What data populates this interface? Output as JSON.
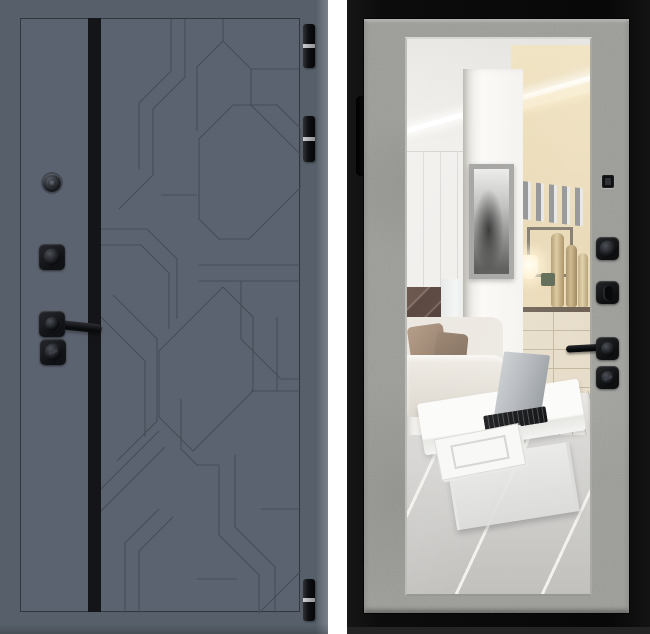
{
  "image_type": "product photo, steel entry door front and back views, no text",
  "front_door": {
    "view": "exterior-side",
    "finish": "graphite gray slab with milled geometric line pattern and black vertical accent stripe",
    "hardware": [
      "peephole",
      "deadbolt-knob",
      "lever-handle",
      "key-cylinder"
    ],
    "hinges": [
      "hinge-top",
      "hinge-upper",
      "hinge-bottom"
    ]
  },
  "back_door": {
    "view": "interior-side",
    "finish": "black slab frame with light concrete-texture surround and full-length mirror insert",
    "hardware": [
      "edge-pull-handle",
      "latch-cover",
      "deadbolt-knob",
      "thumbturn",
      "lever-handle",
      "night-latch-knob"
    ],
    "mirror_reflection": [
      "led-cove-ceiling-light",
      "white-column-with-framed-art-print",
      "white-wardrobe-cabinets",
      "dark-marble-backsplash",
      "metal-letter-wall-decor",
      "glowing-table-lamp",
      "ceramic-vases",
      "beige-sideboard-with-drawers",
      "white-sofa",
      "taupe-pillows",
      "white-coffee-table",
      "open-laptop",
      "magazines",
      "gray-striped-rug"
    ]
  },
  "colors": {
    "background": "#ffffff",
    "door_face": "#5c6370",
    "door_border": "#57606a",
    "pattern_line": "#454c56",
    "stripe": "#141518",
    "hinge_band": "#ccced1",
    "frame_black": "#0c0c0c",
    "concrete": "#9b9b97",
    "mirror_white": "#f2f0ec",
    "warm_wall": "#e9d9b6",
    "sofa": "#ece8e1",
    "pillow": "#a28b77",
    "rug": "#cdccc9",
    "lamp_glow": "#fff3d6",
    "laptop_silver": "#b8bcc0"
  }
}
